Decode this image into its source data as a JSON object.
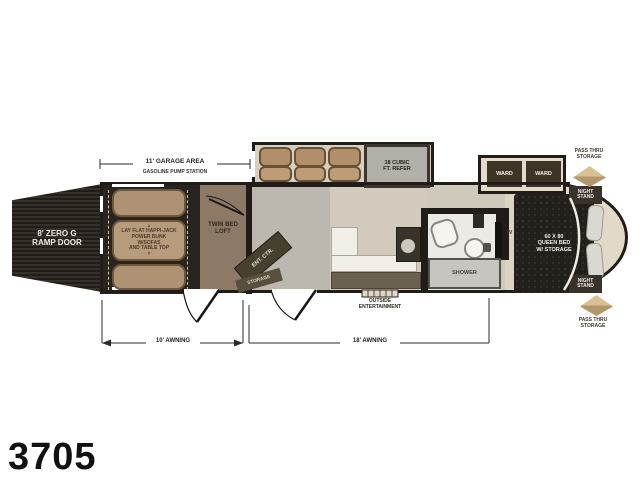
{
  "model_number": "3705",
  "exterior": {
    "ramp_door": "8' ZERO G\nRAMP DOOR",
    "garage_dimension": "11' GARAGE AREA",
    "pump_station": "GASOLINE PUMP STATION",
    "awning_left": "10' AWNING",
    "awning_right": "18' AWNING",
    "outside_entertainment": "OUTSIDE\nENTERTAINMENT",
    "pass_thru_top": "PASS THRU\nSTORAGE",
    "pass_thru_bottom": "PASS THRU\nSTORAGE"
  },
  "garage": {
    "bunk_label": "LAY FLAT HAPPI-JACK\nPOWER BUNK\nW/SOFAS\nAND TABLE TOP",
    "up_arrow": "▲",
    "down_arrow": "▼"
  },
  "loft": {
    "label": "TWIN BED\nLOFT"
  },
  "living": {
    "ent_center": "ENT. CTR.",
    "storage": "STORAGE",
    "refrigerator": "18 CUBIC\nFT. REFER"
  },
  "bathroom": {
    "shower": "SHOWER"
  },
  "bedroom": {
    "wards": [
      "WARD",
      "WARD"
    ],
    "night_stand_top": "NIGHT\nSTAND",
    "night_stand_bottom": "NIGHT\nSTAND",
    "queen_bed": "60 X 80\nQUEEN BED\nW/ STORAGE",
    "tv": "TV"
  },
  "colors": {
    "wall": "#211c18",
    "bunk_tan": "#b0977a",
    "cabinet_olive": "#6a6150",
    "floor_living": "#bcb8af",
    "floor_bedroom": "#dcd4c3",
    "pass_thru_tan": "#c9a876",
    "bed_black": "#23201c"
  }
}
